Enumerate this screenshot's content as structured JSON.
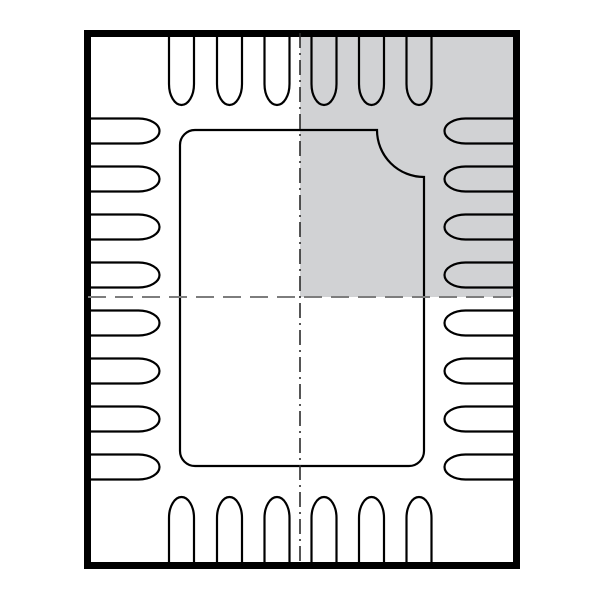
{
  "diagram": {
    "type": "ic-package-outline-top-view",
    "description": "QFN-style 28-pin package outline drawing with exposed center pad, concave pin-1 corner chamfer, dash centerlines and shaded top-right quadrant",
    "canvas": {
      "width": 600,
      "height": 600
    },
    "colors": {
      "background": "#ffffff",
      "outline": "#000000",
      "shading": "#d1d2d4",
      "centerline_horizontal": "#7d7d7d",
      "centerline_vertical": "#2b2b2b"
    },
    "package_body": {
      "outer_x": 84,
      "outer_y": 30,
      "outer_width": 436,
      "outer_height": 539,
      "border_thickness": 7
    },
    "shaded_quadrant": {
      "x": 300,
      "y": 33,
      "width": 215,
      "height": 264
    },
    "exposed_pad": {
      "left": 180,
      "top": 130,
      "right": 424,
      "bottom": 466,
      "corner_radius": 15,
      "chamfer_start_x": 377,
      "chamfer_end_y": 177,
      "chamfer_radius": 47
    },
    "pins": {
      "total": 28,
      "stroke_width": 2.2,
      "half_width": 12.5,
      "cap_depth": 21,
      "left": {
        "count": 8,
        "attach_x": 90,
        "cap_base_x": 138.5,
        "centers_y": [
          131,
          179,
          227,
          275,
          323,
          371,
          419,
          467
        ]
      },
      "right": {
        "count": 8,
        "attach_x": 514,
        "cap_base_x": 465.5,
        "centers_y": [
          131,
          179,
          227,
          275,
          323,
          371,
          419,
          467
        ]
      },
      "top": {
        "count": 6,
        "attach_y": 33,
        "cap_base_y": 84,
        "centers_x": [
          181.5,
          229.5,
          277,
          324,
          371.5,
          419
        ]
      },
      "bottom": {
        "count": 6,
        "attach_y": 566,
        "cap_base_y": 518,
        "centers_x": [
          181.5,
          229.5,
          277,
          324,
          371.5,
          419
        ]
      }
    },
    "centerlines": {
      "vertical": {
        "x": 300,
        "y1": 33,
        "y2": 566,
        "stroke_width": 1.6,
        "dash": "15 5 2 5"
      },
      "horizontal": {
        "y": 297,
        "x1": 88,
        "x2": 515,
        "stroke_width": 2,
        "dash": "18 9"
      }
    },
    "outline_stroke_width": 2.2
  }
}
